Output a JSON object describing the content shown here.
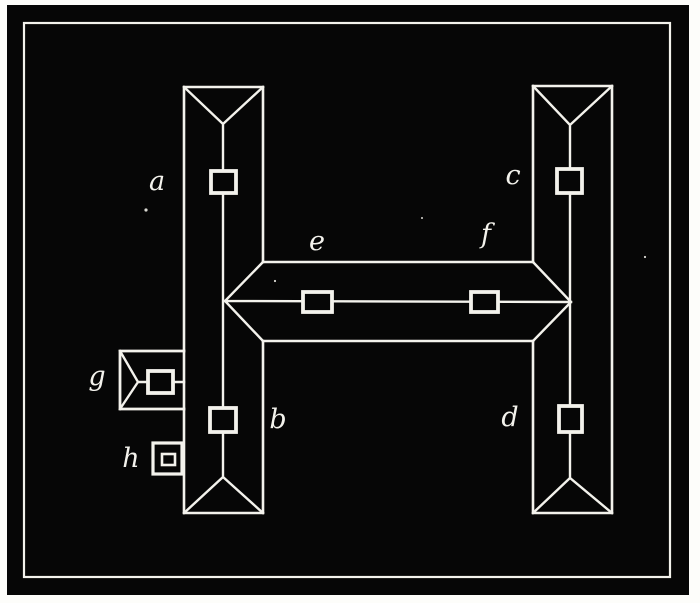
{
  "figure": {
    "kind": "roof-plan-engraving",
    "description": "H-shaped building roof plan, white line engraving on black plate",
    "page_color": "#fdfdfa",
    "plate_color": "#060606",
    "line_color": "#f3f2ec"
  },
  "labels": {
    "left_wing_upper": "a",
    "left_wing_lower": "b",
    "right_wing_upper": "c",
    "right_wing_lower": "d",
    "cross_wing_left": "e",
    "cross_wing_right": "f",
    "outbuilding": "g",
    "annex": "h"
  }
}
